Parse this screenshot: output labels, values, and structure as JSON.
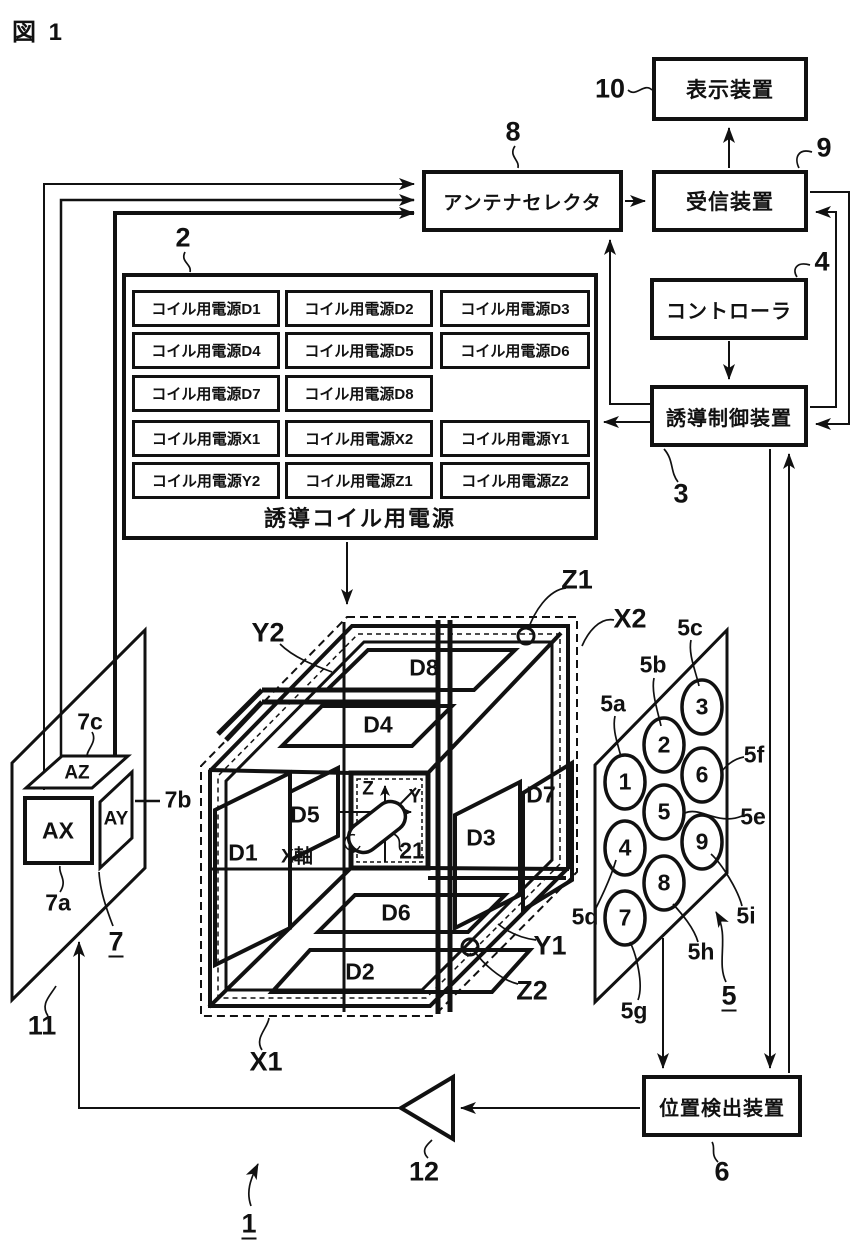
{
  "figure": {
    "label": "図 1",
    "system_ref": "1"
  },
  "blocks": {
    "display": {
      "label": "表示装置",
      "ref": "10"
    },
    "antenna_selector": {
      "label": "アンテナセレクタ",
      "ref": "8"
    },
    "receiver": {
      "label": "受信装置",
      "ref": "9"
    },
    "controller": {
      "label": "コントローラ",
      "ref": "4"
    },
    "guidance_control": {
      "label": "誘導制御装置",
      "ref": "3"
    },
    "position_detector": {
      "label": "位置検出装置",
      "ref": "6"
    },
    "amplifier": {
      "ref": "12"
    }
  },
  "power_supply": {
    "ref": "2",
    "caption": "誘導コイル用電源",
    "cells": [
      "コイル用電源D1",
      "コイル用電源D2",
      "コイル用電源D3",
      "コイル用電源D4",
      "コイル用電源D5",
      "コイル用電源D6",
      "コイル用電源D7",
      "コイル用電源D8",
      "コイル用電源X1",
      "コイル用電源X2",
      "コイル用電源Y1",
      "コイル用電源Y2",
      "コイル用電源Z1",
      "コイル用電源Z2"
    ]
  },
  "cube": {
    "coil_labels": [
      "D8",
      "D4",
      "D1",
      "D5",
      "D3",
      "D7",
      "D6",
      "D2"
    ],
    "axis_labels": {
      "z": "Z",
      "y": "Y",
      "x": "X軸"
    },
    "capsule_ref": "21",
    "winding_labels": {
      "y2": "Y2",
      "z1": "Z1",
      "x2": "X2",
      "x1": "X1",
      "y1": "Y1",
      "z2": "Z2"
    }
  },
  "probe": {
    "ax": "AX",
    "ay": "AY",
    "az": "AZ",
    "refs": {
      "a": "7a",
      "b": "7b",
      "c": "7c",
      "unit": "7",
      "plane": "11"
    }
  },
  "panel": {
    "ref": "5",
    "digits": [
      "1",
      "2",
      "3",
      "4",
      "5",
      "6",
      "7",
      "8",
      "9"
    ],
    "refs": [
      "5a",
      "5b",
      "5c",
      "5d",
      "5e",
      "5f",
      "5g",
      "5h",
      "5i"
    ]
  },
  "colors": {
    "ink": "#111111",
    "bg": "#ffffff"
  }
}
